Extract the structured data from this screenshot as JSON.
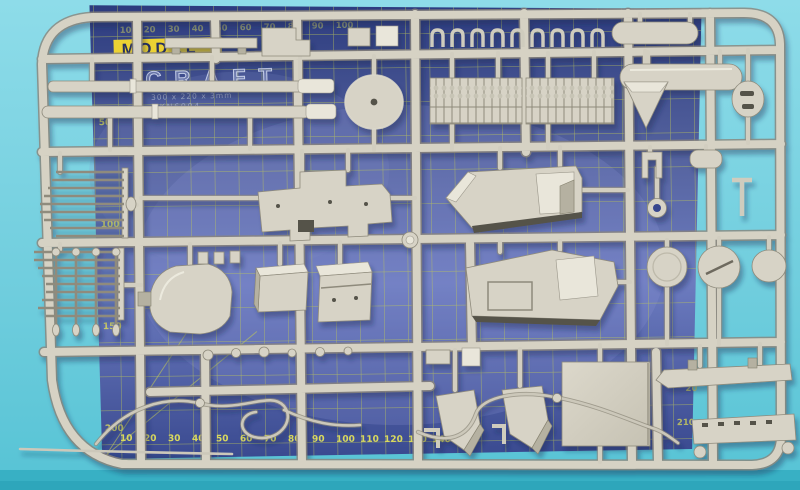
{
  "scene": {
    "type": "photograph",
    "subject": "Light-grey injection-moulded model kit sprue with armoured-vehicle parts lying on a blue self-healing cutting mat on a turquoise table"
  },
  "colors": {
    "table_top": "#8edce9",
    "table_bottom": "#56c3d5",
    "table_edge_strip": "#2fa7bc",
    "mat_dark": "#2c3b7e",
    "mat_light": "#6d7cc0",
    "mat_grid": "#bfc857",
    "mat_numbers": "#d9d95e",
    "label_yellow": "#ecd233",
    "sprue_plastic": "#d6d2c4",
    "sprue_shadow": "#89857a"
  },
  "mat": {
    "brand_top": "MODEL",
    "brand_bottom": "CRAFT",
    "spec_line": "300 x 220 x 3mm",
    "product_code": "PKN6004",
    "rulers": {
      "top": [
        "10",
        "20",
        "30",
        "40",
        "50",
        "60",
        "70",
        "80",
        "90",
        "100"
      ],
      "bottom": [
        "10",
        "20",
        "30",
        "40",
        "50",
        "60",
        "70",
        "80",
        "90",
        "100",
        "110",
        "120",
        "130",
        "140",
        "150"
      ],
      "left": [
        "50",
        "100",
        "150",
        "200"
      ],
      "corner": [
        "20",
        "210"
      ]
    }
  },
  "sprue": {
    "parts": [
      "outer-frame",
      "runner-lattice",
      "sprue-joiner-knob",
      "gun-barrel-long",
      "gun-barrel-short",
      "turret-base-disc",
      "track-section-left",
      "track-section-right",
      "grab-handle-set",
      "mounting-bar",
      "step-bracket",
      "block-pair",
      "fuel-tank-small",
      "fuel-tank-large",
      "armor-wedge",
      "vent-hatch-disc",
      "clevis-bracket",
      "small-cylinder",
      "towing-ring",
      "t-rod",
      "hull-roof-plate",
      "hull-superstructure",
      "hull-side-plate",
      "leaf-spring-upper",
      "leaf-spring-lower",
      "transmission-cover",
      "stowage-box-small",
      "stowage-box-large",
      "axle-rod-set",
      "stud-row",
      "road-wheel-left",
      "road-wheel-center",
      "road-wheel-right",
      "floor-panel",
      "fender-left",
      "fender-right",
      "side-skirt-beam-upper",
      "side-skirt-beam-lower",
      "tow-cable-left",
      "tow-cable-right",
      "bottom-wire"
    ]
  }
}
